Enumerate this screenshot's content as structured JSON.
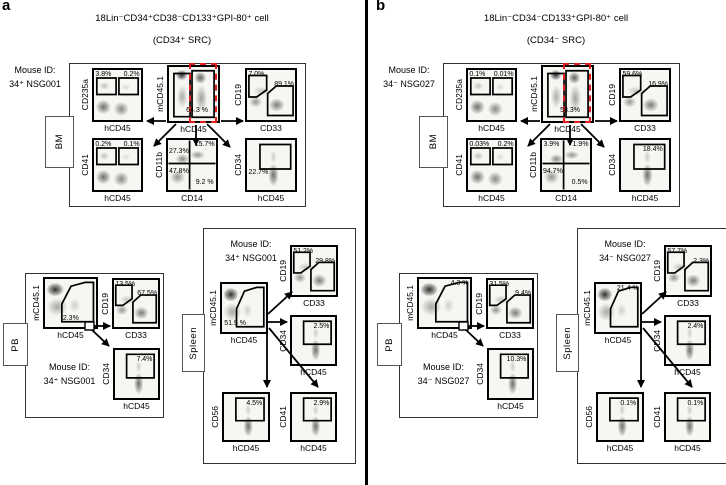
{
  "panels": [
    {
      "letter": "a",
      "title": "18Lin⁻CD34⁺CD38⁻CD133⁺GPI-80⁺ cell",
      "subtitle": "(CD34⁺ SRC)",
      "sections": [
        {
          "name": "BM",
          "mouse_id_label": "Mouse ID:",
          "mouse_id": "34⁺ NSG001",
          "plots": [
            {
              "kind": "dual-top",
              "ylabel": "CD235a",
              "xlabel": "hCD45",
              "labels": [
                {
                  "text": "3.8%",
                  "pos": "tl"
                },
                {
                  "text": "0.2%",
                  "pos": "tr"
                }
              ]
            },
            {
              "kind": "center-bm",
              "ylabel": "mCD45.1",
              "xlabel": "hCD45",
              "red_gate": true,
              "labels": [
                {
                  "text": "64.3 %",
                  "pos": "bm"
                }
              ]
            },
            {
              "kind": "cd19cd33",
              "ylabel": "CD19",
              "xlabel": "CD33",
              "labels": [
                {
                  "text": "7.0%",
                  "pos": "tl"
                },
                {
                  "text": "89.1%",
                  "pos": "mr"
                }
              ]
            },
            {
              "kind": "dual-top",
              "ylabel": "CD41",
              "xlabel": "hCD45",
              "labels": [
                {
                  "text": "0.2%",
                  "pos": "tl"
                },
                {
                  "text": "0.1%",
                  "pos": "tr"
                }
              ]
            },
            {
              "kind": "quad",
              "ylabel": "CD11b",
              "xlabel": "CD14",
              "labels": [
                {
                  "text": "27.3%",
                  "pos": "ql"
                },
                {
                  "text": "15.7%",
                  "pos": "tr"
                },
                {
                  "text": "47.8%",
                  "pos": "q3"
                },
                {
                  "text": "9.2 %",
                  "pos": "br"
                }
              ]
            },
            {
              "kind": "gate-top",
              "ylabel": "CD34",
              "xlabel": "hCD45",
              "labels": [
                {
                  "text": "22.7%",
                  "pos": "ml"
                }
              ]
            }
          ]
        },
        {
          "name": "PB",
          "mouse_id_label": "Mouse ID:",
          "mouse_id": "34⁺ NSG001",
          "plots": [
            {
              "kind": "main-gate",
              "ylabel": "mCD45.1",
              "xlabel": "hCD45",
              "labels": [
                {
                  "text": "2.3%",
                  "pos": "bm"
                }
              ]
            },
            {
              "kind": "cd19cd33",
              "ylabel": "CD19",
              "xlabel": "CD33",
              "labels": [
                {
                  "text": "13.5%",
                  "pos": "tl"
                },
                {
                  "text": "67.5%",
                  "pos": "mr"
                }
              ]
            },
            {
              "kind": "gate-top",
              "ylabel": "CD34",
              "xlabel": "hCD45",
              "labels": [
                {
                  "text": "7.4%",
                  "pos": "ti"
                }
              ]
            }
          ]
        },
        {
          "name": "Spleen",
          "mouse_id_label": "Mouse ID:",
          "mouse_id": "34⁺ NSG001",
          "plots": [
            {
              "kind": "main-gate",
              "ylabel": "mCD45.1",
              "xlabel": "hCD45",
              "labels": [
                {
                  "text": "51.9 %",
                  "pos": "bl"
                }
              ]
            },
            {
              "kind": "cd19cd33",
              "ylabel": "CD19",
              "xlabel": "CD33",
              "labels": [
                {
                  "text": "51.2%",
                  "pos": "tl"
                },
                {
                  "text": "29.8%",
                  "pos": "mr"
                }
              ]
            },
            {
              "kind": "gate-top",
              "ylabel": "CD34",
              "xlabel": "hCD45",
              "labels": [
                {
                  "text": "2.5%",
                  "pos": "ti"
                }
              ]
            },
            {
              "kind": "gate-top",
              "ylabel": "CD56",
              "xlabel": "hCD45",
              "labels": [
                {
                  "text": "4.5%",
                  "pos": "ti"
                }
              ]
            },
            {
              "kind": "gate-top",
              "ylabel": "CD41",
              "xlabel": "hCD45",
              "labels": [
                {
                  "text": "2.9%",
                  "pos": "ti"
                }
              ]
            }
          ]
        }
      ]
    },
    {
      "letter": "b",
      "title": "18Lin⁻CD34⁻CD133⁺GPI-80⁺ cell",
      "subtitle": "(CD34⁻ SRC)",
      "sections": [
        {
          "name": "BM",
          "mouse_id_label": "Mouse ID:",
          "mouse_id": "34⁻ NSG027",
          "plots": [
            {
              "kind": "dual-top",
              "ylabel": "CD235a",
              "xlabel": "hCD45",
              "labels": [
                {
                  "text": "0.1%",
                  "pos": "tl"
                },
                {
                  "text": "0.01%",
                  "pos": "tr"
                }
              ]
            },
            {
              "kind": "center-bm",
              "ylabel": "mCD45.1",
              "xlabel": "hCD45",
              "red_gate": true,
              "labels": [
                {
                  "text": "58.3%",
                  "pos": "bm"
                }
              ]
            },
            {
              "kind": "cd19cd33",
              "ylabel": "CD19",
              "xlabel": "CD33",
              "labels": [
                {
                  "text": "59.6%",
                  "pos": "tl"
                },
                {
                  "text": "16.9%",
                  "pos": "mr"
                }
              ]
            },
            {
              "kind": "dual-top",
              "ylabel": "CD41",
              "xlabel": "hCD45",
              "labels": [
                {
                  "text": "0.03%",
                  "pos": "tl"
                },
                {
                  "text": "0.2%",
                  "pos": "tr"
                }
              ]
            },
            {
              "kind": "quad",
              "ylabel": "CD11b",
              "xlabel": "CD14",
              "labels": [
                {
                  "text": "3.9%",
                  "pos": "tl"
                },
                {
                  "text": "1.9%",
                  "pos": "tr"
                },
                {
                  "text": "94.7%",
                  "pos": "q3"
                },
                {
                  "text": "0.5%",
                  "pos": "br"
                }
              ]
            },
            {
              "kind": "gate-top",
              "ylabel": "CD34",
              "xlabel": "hCD45",
              "labels": [
                {
                  "text": "18.4%",
                  "pos": "ti"
                }
              ]
            }
          ]
        },
        {
          "name": "PB",
          "mouse_id_label": "Mouse ID:",
          "mouse_id": "34⁻ NSG027",
          "plots": [
            {
              "kind": "main-gate",
              "ylabel": "mCD45.1",
              "xlabel": "hCD45",
              "labels": [
                {
                  "text": "4.3 %",
                  "pos": "tr"
                }
              ]
            },
            {
              "kind": "cd19cd33",
              "ylabel": "CD19",
              "xlabel": "CD33",
              "labels": [
                {
                  "text": "31.5%",
                  "pos": "tl"
                },
                {
                  "text": "9.4%",
                  "pos": "mr"
                }
              ]
            },
            {
              "kind": "gate-top",
              "ylabel": "CD34",
              "xlabel": "hCD45",
              "labels": [
                {
                  "text": "10.3%",
                  "pos": "ti"
                }
              ]
            }
          ]
        },
        {
          "name": "Spleen",
          "mouse_id_label": "Mouse ID:",
          "mouse_id": "34⁻ NSG027",
          "plots": [
            {
              "kind": "main-gate",
              "ylabel": "mCD45.1",
              "xlabel": "hCD45",
              "labels": [
                {
                  "text": "21.4 %",
                  "pos": "tr"
                }
              ]
            },
            {
              "kind": "cd19cd33",
              "ylabel": "CD19",
              "xlabel": "CD33",
              "labels": [
                {
                  "text": "57.7%",
                  "pos": "tl"
                },
                {
                  "text": "2.3%",
                  "pos": "mr"
                }
              ]
            },
            {
              "kind": "gate-top",
              "ylabel": "CD34",
              "xlabel": "hCD45",
              "labels": [
                {
                  "text": "2.4%",
                  "pos": "ti"
                }
              ]
            },
            {
              "kind": "gate-top",
              "ylabel": "CD56",
              "xlabel": "hCD45",
              "labels": [
                {
                  "text": "0.1%",
                  "pos": "ti"
                }
              ]
            },
            {
              "kind": "gate-top",
              "ylabel": "CD41",
              "xlabel": "hCD45",
              "labels": [
                {
                  "text": "0.1%",
                  "pos": "ti"
                }
              ]
            }
          ]
        }
      ]
    }
  ],
  "colors": {
    "gate": "#000000",
    "red_gate": "#e31e1e",
    "divider": "#000000"
  }
}
